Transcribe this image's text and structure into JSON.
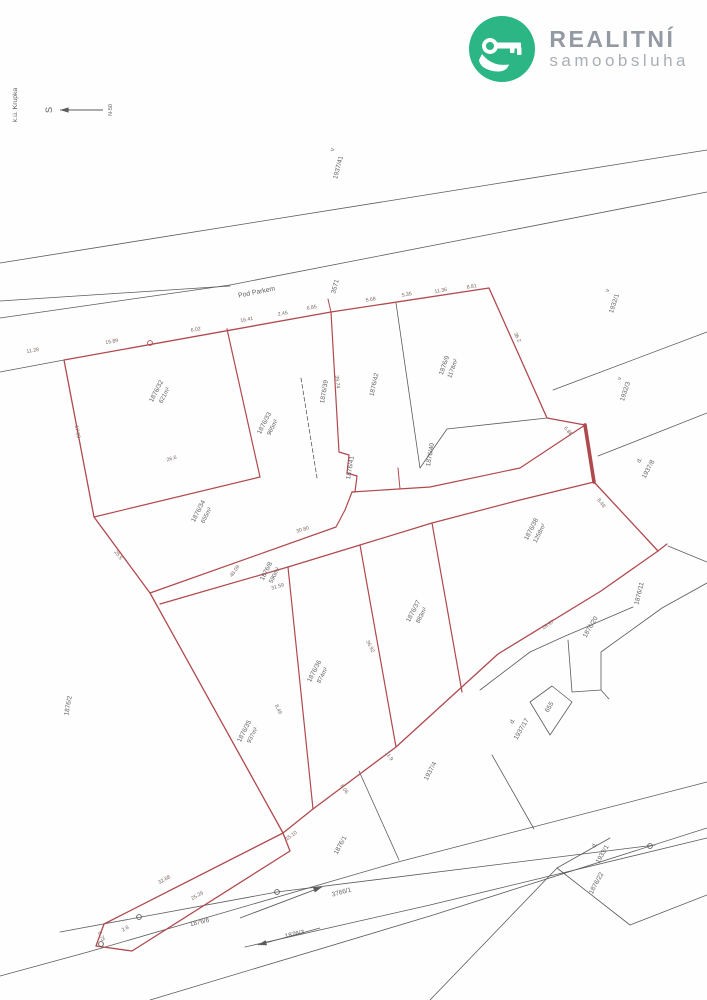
{
  "logo": {
    "title": "REALITNÍ",
    "subtitle": "samoobsluha",
    "green": "#2cb585",
    "icon": "key-in-hand-icon"
  },
  "map": {
    "region_label": "k.ú. Krupka",
    "north_label": "S",
    "north_scale_label": "N-50",
    "road_name": "Pod Parkem",
    "colors": {
      "red": "#b0494d",
      "black": "#5b5b5b",
      "label": "#5f5f63",
      "measure": "#7a6660"
    },
    "red_polylines": [
      {
        "points": "64,360 331,312 489,288 547,418 585,425 594,482 658,551 601,591 498,654 396,747 313,809 283,833 150,593 94,517 64,360",
        "w": 1.3
      },
      {
        "points": "283,833 104,924 96,946 132,951 290,851 283,833",
        "w": 1.3
      },
      {
        "points": "227,329 260,477",
        "w": 1.2
      },
      {
        "points": "94,517 260,477",
        "w": 1.2
      },
      {
        "points": "331,312 339,452 349,455 347,473 357,476 355,492 352,492",
        "w": 1.2
      },
      {
        "points": "150,593 336,527 345,510 352,492 430,487 520,468 585,425",
        "w": 1.2
      },
      {
        "points": "160,604 288,567 360,545 432,523 520,500 594,482",
        "w": 1.2
      },
      {
        "points": "288,567 313,809",
        "w": 1.2
      },
      {
        "points": "360,545 396,747",
        "w": 1.2
      },
      {
        "points": "432,523 462,692",
        "w": 1.2
      },
      {
        "points": "658,551 667,544",
        "w": 1.2
      },
      {
        "points": "331,312 328,299",
        "w": 1.0
      },
      {
        "points": "400,489 398,468",
        "w": 1.0
      },
      {
        "points": "585,425 594,482",
        "w": 3.6
      }
    ],
    "black_polylines": [
      {
        "points": "0,263 707,150",
        "w": 0.8
      },
      {
        "points": "0,318 230,285 707,192",
        "w": 0.8
      },
      {
        "points": "0,301 230,286",
        "w": 0.8
      },
      {
        "points": "0,372 64,360",
        "w": 0.8
      },
      {
        "points": "553,390 707,332",
        "w": 0.8
      },
      {
        "points": "598,456 707,413",
        "w": 0.8
      },
      {
        "points": "396,303 420,468",
        "w": 0.8
      },
      {
        "points": "420,468 447,429 547,418",
        "w": 0.8
      },
      {
        "points": "633,607 563,637 530,652 480,690",
        "w": 0.8
      },
      {
        "points": "568,640 572,692 601,690 601,652 662,608 707,583",
        "w": 0.8
      },
      {
        "points": "601,690 609,699",
        "w": 0.8
      },
      {
        "points": "530,702 552,686 572,702 550,735 530,702",
        "w": 0.8
      },
      {
        "points": "668,546 707,562",
        "w": 0.8
      },
      {
        "points": "359,771 399,860",
        "w": 0.8
      },
      {
        "points": "492,755 534,829",
        "w": 0.8
      },
      {
        "points": "0,976 88,952 398,862 707,782",
        "w": 0.8
      },
      {
        "points": "150,1000 430,916 707,828",
        "w": 0.8
      },
      {
        "points": "245,947 430,905 707,838",
        "w": 0.8
      },
      {
        "points": "60,932 277,892 655,845",
        "w": 0.8
      },
      {
        "points": "430,1000 557,868",
        "w": 0.8
      },
      {
        "points": "557,868 630,925",
        "w": 0.8
      },
      {
        "points": "630,925 707,895",
        "w": 0.8
      },
      {
        "points": "557,868 610,838",
        "w": 0.8
      }
    ],
    "dashed_polylines": [
      {
        "points": "301,378 317,478",
        "w": 0.8
      }
    ],
    "circles": [
      {
        "x": 150,
        "y": 343,
        "r": 2.4,
        "c": "red"
      },
      {
        "x": 101,
        "y": 944,
        "r": 2.4,
        "c": "black"
      },
      {
        "x": 139,
        "y": 917,
        "r": 2.4,
        "c": "black"
      },
      {
        "x": 277,
        "y": 892,
        "r": 2.4,
        "c": "black"
      },
      {
        "x": 650,
        "y": 846,
        "r": 2.4,
        "c": "black"
      }
    ],
    "arrows": [
      {
        "x1": 103,
        "y1": 110,
        "x2": 60,
        "y2": 110,
        "name": "north-arrow"
      },
      {
        "x1": 240,
        "y1": 918,
        "x2": 322,
        "y2": 887,
        "name": "road-direction-arrow"
      },
      {
        "x1": 320,
        "y1": 928,
        "x2": 258,
        "y2": 945,
        "name": "parcel-1876-3-arrow"
      }
    ],
    "parcel_labels": [
      {
        "num": "1876/32",
        "area": "621m²",
        "x": 158,
        "y": 392,
        "rot": -63
      },
      {
        "num": "1876/33",
        "area": "965m²",
        "x": 266,
        "y": 424,
        "rot": -63
      },
      {
        "num": "1876/39",
        "area": "",
        "x": 326,
        "y": 392,
        "rot": -80
      },
      {
        "num": "1876/42",
        "area": "",
        "x": 376,
        "y": 385,
        "rot": -78
      },
      {
        "num": "1876/9",
        "area": "1178m²",
        "x": 446,
        "y": 366,
        "rot": -70
      },
      {
        "num": "1876/34",
        "area": "655m²",
        "x": 200,
        "y": 512,
        "rot": -63
      },
      {
        "num": "1876/8",
        "area": "590m²",
        "x": 268,
        "y": 572,
        "rot": -63
      },
      {
        "num": "1876/41",
        "area": "",
        "x": 352,
        "y": 468,
        "rot": -80
      },
      {
        "num": "1876/40",
        "area": "",
        "x": 432,
        "y": 455,
        "rot": -80
      },
      {
        "num": "1876/38",
        "area": "1258m²",
        "x": 533,
        "y": 530,
        "rot": -63
      },
      {
        "num": "1876/37",
        "area": "883m²",
        "x": 415,
        "y": 612,
        "rot": -63
      },
      {
        "num": "1876/36",
        "area": "874m²",
        "x": 316,
        "y": 672,
        "rot": -63
      },
      {
        "num": "1876/35",
        "area": "937m²",
        "x": 246,
        "y": 732,
        "rot": -63
      }
    ],
    "neighbor_labels": [
      {
        "text": "1937/41",
        "x": 340,
        "y": 168,
        "rot": -75
      },
      {
        "text": "1932/1",
        "x": 616,
        "y": 304,
        "rot": -72
      },
      {
        "text": "1932/3",
        "x": 627,
        "y": 392,
        "rot": -72
      },
      {
        "text": "1937/8",
        "x": 650,
        "y": 470,
        "rot": -62
      },
      {
        "text": "1876/11",
        "x": 641,
        "y": 594,
        "rot": -76
      },
      {
        "text": "1876/20",
        "x": 592,
        "y": 628,
        "rot": -60
      },
      {
        "text": "1937/17",
        "x": 523,
        "y": 730,
        "rot": -60
      },
      {
        "text": "655",
        "x": 551,
        "y": 708,
        "rot": -60
      },
      {
        "text": "1937/4",
        "x": 432,
        "y": 772,
        "rot": -62
      },
      {
        "text": "1933/1",
        "x": 604,
        "y": 855,
        "rot": -60
      },
      {
        "text": "1876/22",
        "x": 598,
        "y": 884,
        "rot": -62
      },
      {
        "text": "1876/2",
        "x": 70,
        "y": 706,
        "rot": -80
      },
      {
        "text": "1876/1",
        "x": 342,
        "y": 846,
        "rot": -62
      },
      {
        "text": "1876/6",
        "x": 200,
        "y": 924,
        "rot": -13
      },
      {
        "text": "1876/3",
        "x": 295,
        "y": 936,
        "rot": -13
      },
      {
        "text": "3766/1",
        "x": 342,
        "y": 894,
        "rot": -15
      },
      {
        "text": "3571",
        "x": 337,
        "y": 287,
        "rot": -75
      }
    ],
    "marks": [
      {
        "text": "v",
        "x": 334,
        "y": 150,
        "rot": -75
      },
      {
        "text": "v",
        "x": 609,
        "y": 291,
        "rot": -72
      },
      {
        "text": "v",
        "x": 621,
        "y": 379,
        "rot": -72
      },
      {
        "text": "d.",
        "x": 641,
        "y": 461,
        "rot": -62
      },
      {
        "text": "d.",
        "x": 514,
        "y": 722,
        "rot": -60
      },
      {
        "text": "d.",
        "x": 596,
        "y": 846,
        "rot": -60
      }
    ],
    "measurements": [
      [
        "11.28",
        33,
        352,
        -10
      ],
      [
        "15.89",
        112,
        343,
        -10
      ],
      [
        "6.02",
        196,
        331,
        -10
      ],
      [
        "16.41",
        247,
        321,
        -10
      ],
      [
        "2.45",
        283,
        315,
        -10
      ],
      [
        "6.85",
        312,
        309,
        -10
      ],
      [
        "5.68",
        371,
        301,
        -10
      ],
      [
        "5.35",
        407,
        296,
        -10
      ],
      [
        "11.36",
        441,
        292,
        -10
      ],
      [
        "8.81",
        472,
        288,
        -10
      ],
      [
        "36.2",
        516,
        338,
        64
      ],
      [
        "6.88",
        567,
        432,
        50
      ],
      [
        "8.48",
        600,
        504,
        52
      ],
      [
        "39.74",
        336,
        382,
        84
      ],
      [
        "26.6",
        172,
        460,
        -17
      ],
      [
        "48.09",
        236,
        572,
        -55
      ],
      [
        "30.80",
        303,
        531,
        -17
      ],
      [
        "31.59",
        278,
        588,
        -17
      ],
      [
        "36.92",
        369,
        647,
        63
      ],
      [
        "8.49",
        277,
        710,
        63
      ],
      [
        "28.57",
        549,
        626,
        -33
      ],
      [
        "15.10",
        292,
        837,
        -35
      ],
      [
        "8.06",
        343,
        790,
        55
      ],
      [
        "11.9",
        388,
        757,
        55
      ],
      [
        "32.68",
        165,
        881,
        -30
      ],
      [
        "25.29",
        198,
        897,
        -30
      ],
      [
        "2.8",
        126,
        930,
        -30
      ],
      [
        "0.75",
        100,
        937,
        65
      ],
      [
        "17.09",
        76,
        432,
        80
      ],
      [
        "25.5",
        117,
        556,
        55
      ]
    ]
  }
}
